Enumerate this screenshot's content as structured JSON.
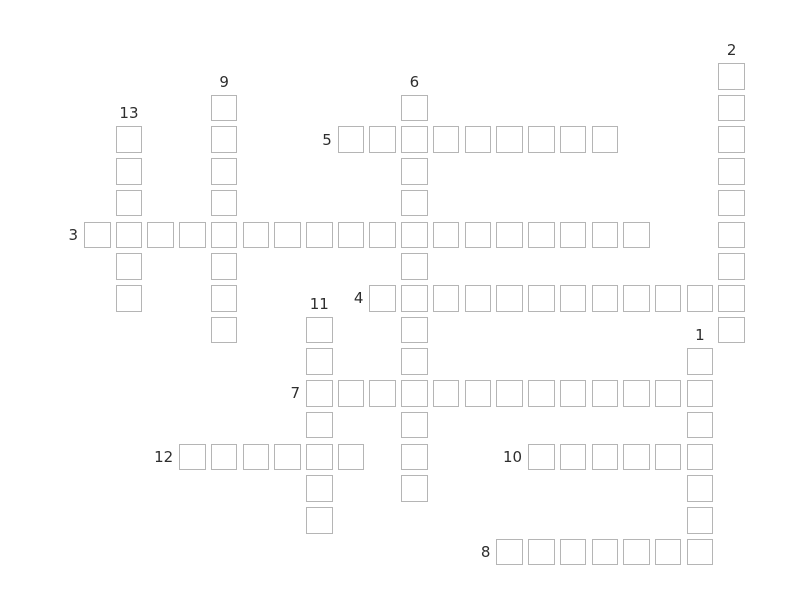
{
  "app": {
    "name": "crossword-puzzle",
    "background_color": "#ffffff"
  },
  "colors": {
    "cell_border": "#b5b5b5",
    "cell_fill": "#ffffff",
    "clue_number_text": "#2e2e2e"
  },
  "puzzle": {
    "type": "crossword",
    "state": "empty",
    "clue_numbers_visible": [
      1,
      2,
      3,
      4,
      5,
      6,
      7,
      8,
      9,
      10,
      11,
      12,
      13
    ],
    "words": [
      {
        "number": 1,
        "direction": "down",
        "col": 19,
        "row": 9,
        "length": 7
      },
      {
        "number": 2,
        "direction": "down",
        "col": 20,
        "row": 0,
        "length": 9
      },
      {
        "number": 3,
        "direction": "across",
        "col": 0,
        "row": 5,
        "length": 18
      },
      {
        "number": 4,
        "direction": "across",
        "col": 9,
        "row": 7,
        "length": 12
      },
      {
        "number": 5,
        "direction": "across",
        "col": 8,
        "row": 2,
        "length": 9
      },
      {
        "number": 6,
        "direction": "down",
        "col": 10,
        "row": 1,
        "length": 13
      },
      {
        "number": 7,
        "direction": "across",
        "col": 7,
        "row": 10,
        "length": 13
      },
      {
        "number": 8,
        "direction": "across",
        "col": 13,
        "row": 15,
        "length": 7
      },
      {
        "number": 9,
        "direction": "down",
        "col": 4,
        "row": 1,
        "length": 8
      },
      {
        "number": 10,
        "direction": "across",
        "col": 14,
        "row": 12,
        "length": 6
      },
      {
        "number": 11,
        "direction": "down",
        "col": 7,
        "row": 8,
        "length": 7
      },
      {
        "number": 12,
        "direction": "across",
        "col": 3,
        "row": 12,
        "length": 6
      },
      {
        "number": 13,
        "direction": "down",
        "col": 1,
        "row": 2,
        "length": 6
      }
    ],
    "cell_values": {}
  }
}
